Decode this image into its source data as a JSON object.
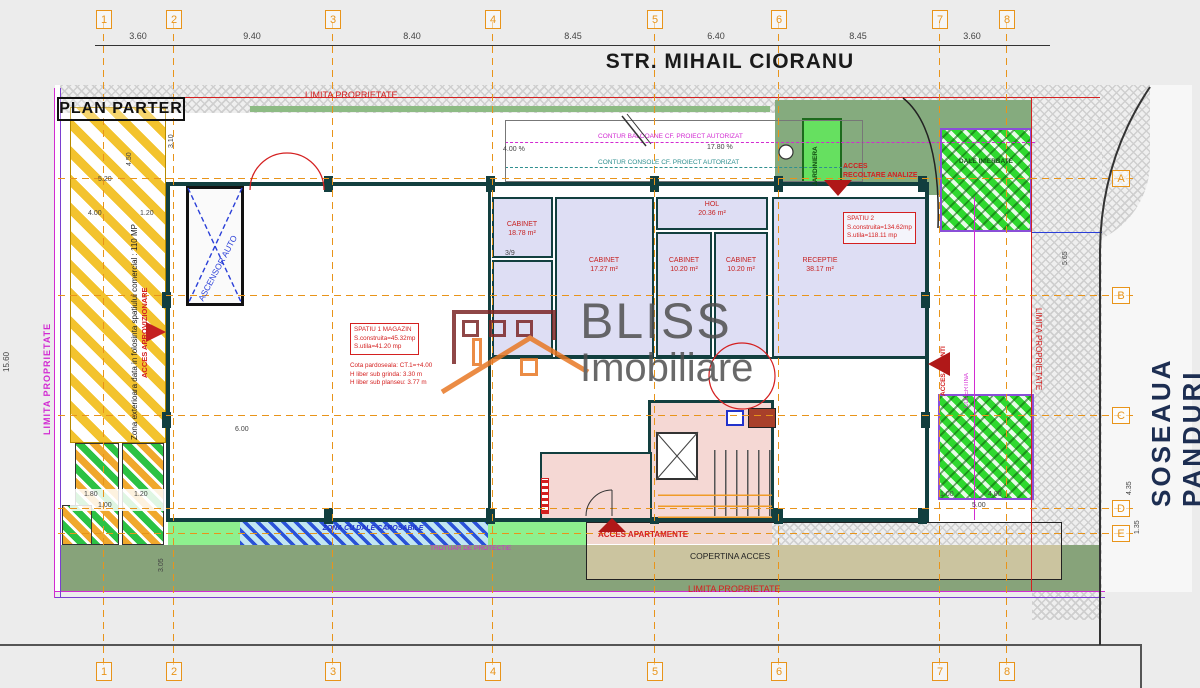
{
  "streets": {
    "top": "STR. MIHAIL CIORANU",
    "right": "SOSEAUA PANDURI"
  },
  "plan": {
    "title": "PLAN PARTER"
  },
  "watermark": {
    "brand": "BLISS",
    "sub": "Imobiliare"
  },
  "grid": {
    "cols": [
      "1",
      "2",
      "3",
      "4",
      "5",
      "6",
      "7",
      "8"
    ],
    "rows": [
      "A",
      "B",
      "C",
      "D",
      "E"
    ]
  },
  "dims": {
    "top": [
      "3.60",
      "9.40",
      "8.40",
      "8.45",
      "6.40",
      "8.45",
      "3.60"
    ],
    "left": {
      "d520": "5.20",
      "d400": "4.00",
      "d120": "1.20",
      "d450": "4.50",
      "d310": "3.10",
      "d1560": "15.60"
    },
    "right": {
      "d565": "5.65",
      "d435": "4.35",
      "d135": "1.35"
    },
    "bottom_left": {
      "d180": "1.80",
      "d120": "1.20",
      "d100": "1.00",
      "d305": "3.05"
    },
    "misc": {
      "d600": "6.00",
      "stair": "3/9",
      "d100b": "1.00",
      "d400b": "4.00",
      "d500": "5.00"
    }
  },
  "rooms": [
    {
      "name": "CABINET",
      "area": "18.78 m²"
    },
    {
      "name": "CABINET",
      "area": "17.27 m²"
    },
    {
      "name": "HOL",
      "area": "20.36 m²"
    },
    {
      "name": "CABINET",
      "area": "10.20 m²"
    },
    {
      "name": "CABINET",
      "area": "10.20 m²"
    },
    {
      "name": "RECEPTIE",
      "area": "38.17 m²"
    }
  ],
  "annotations": {
    "limita_top": "LIMITA PROPRIETATE",
    "limita_bottom": "LIMITA PROPRIETATE",
    "limita_left": "LIMITA PROPRIETATE",
    "limita_right": "LIMITA PROPRIETATE",
    "contur_balcoane": "CONTUR BALCOANE CF. PROIECT AUTORIZAT",
    "contur_console": "CONTUR CONSOLE CF. PROIECT AUTORIZAT",
    "pct_1780": "17.80 %",
    "pct_400": "4.00 %",
    "zona_exterioara": "Zona exterioara data in folosinta spatiului comercial : 110 MP",
    "acces_aprovizionare": "ACCES APROVIZIONARE",
    "ascensor_auto": "ASCENSOR AUTO",
    "jardiniera": "JARDINIERA",
    "dale_inierbate": "DALE INIERBATE",
    "acces_recoltare_1": "ACCES",
    "acces_recoltare_2": "RECOLTARE ANALIZE",
    "acces_clienti": "ACCES CLIENTI",
    "copertina_side": "COPERTINA",
    "acces_apartamente": "ACCES APARTAMENTE",
    "copertina_acces": "COPERTINA ACCES",
    "zona_dale": "ZONA CU DALE CAROSABILE",
    "trotuar": "TROTUAR DE PROTECTIE",
    "spatiu2": {
      "l1": "SPATIU 2",
      "l2": "S.construita=134.62mp",
      "l3": "S.utila=118.11 mp"
    },
    "spatiu1": {
      "l1": "SPATIU 1 MAGAZIN",
      "l2": "S.construita=45.32mp",
      "l3": "S.utila=41.20 mp",
      "l4": "Cota pardoseala: CT.1=+4.00",
      "l5": "H liber sub grinda: 3.30 m",
      "l6": "H liber sub planseu: 3.77 m"
    }
  },
  "colors": {
    "grid_orange": "#e8941a",
    "wall": "#123f3f",
    "room_label_red": "#c62222",
    "limita_magenta": "#d22ad2",
    "limita_red": "#d42020",
    "street_text": "#1d2e52",
    "roof_orange": "#e87722",
    "brand_dark_red": "#7a2424"
  }
}
